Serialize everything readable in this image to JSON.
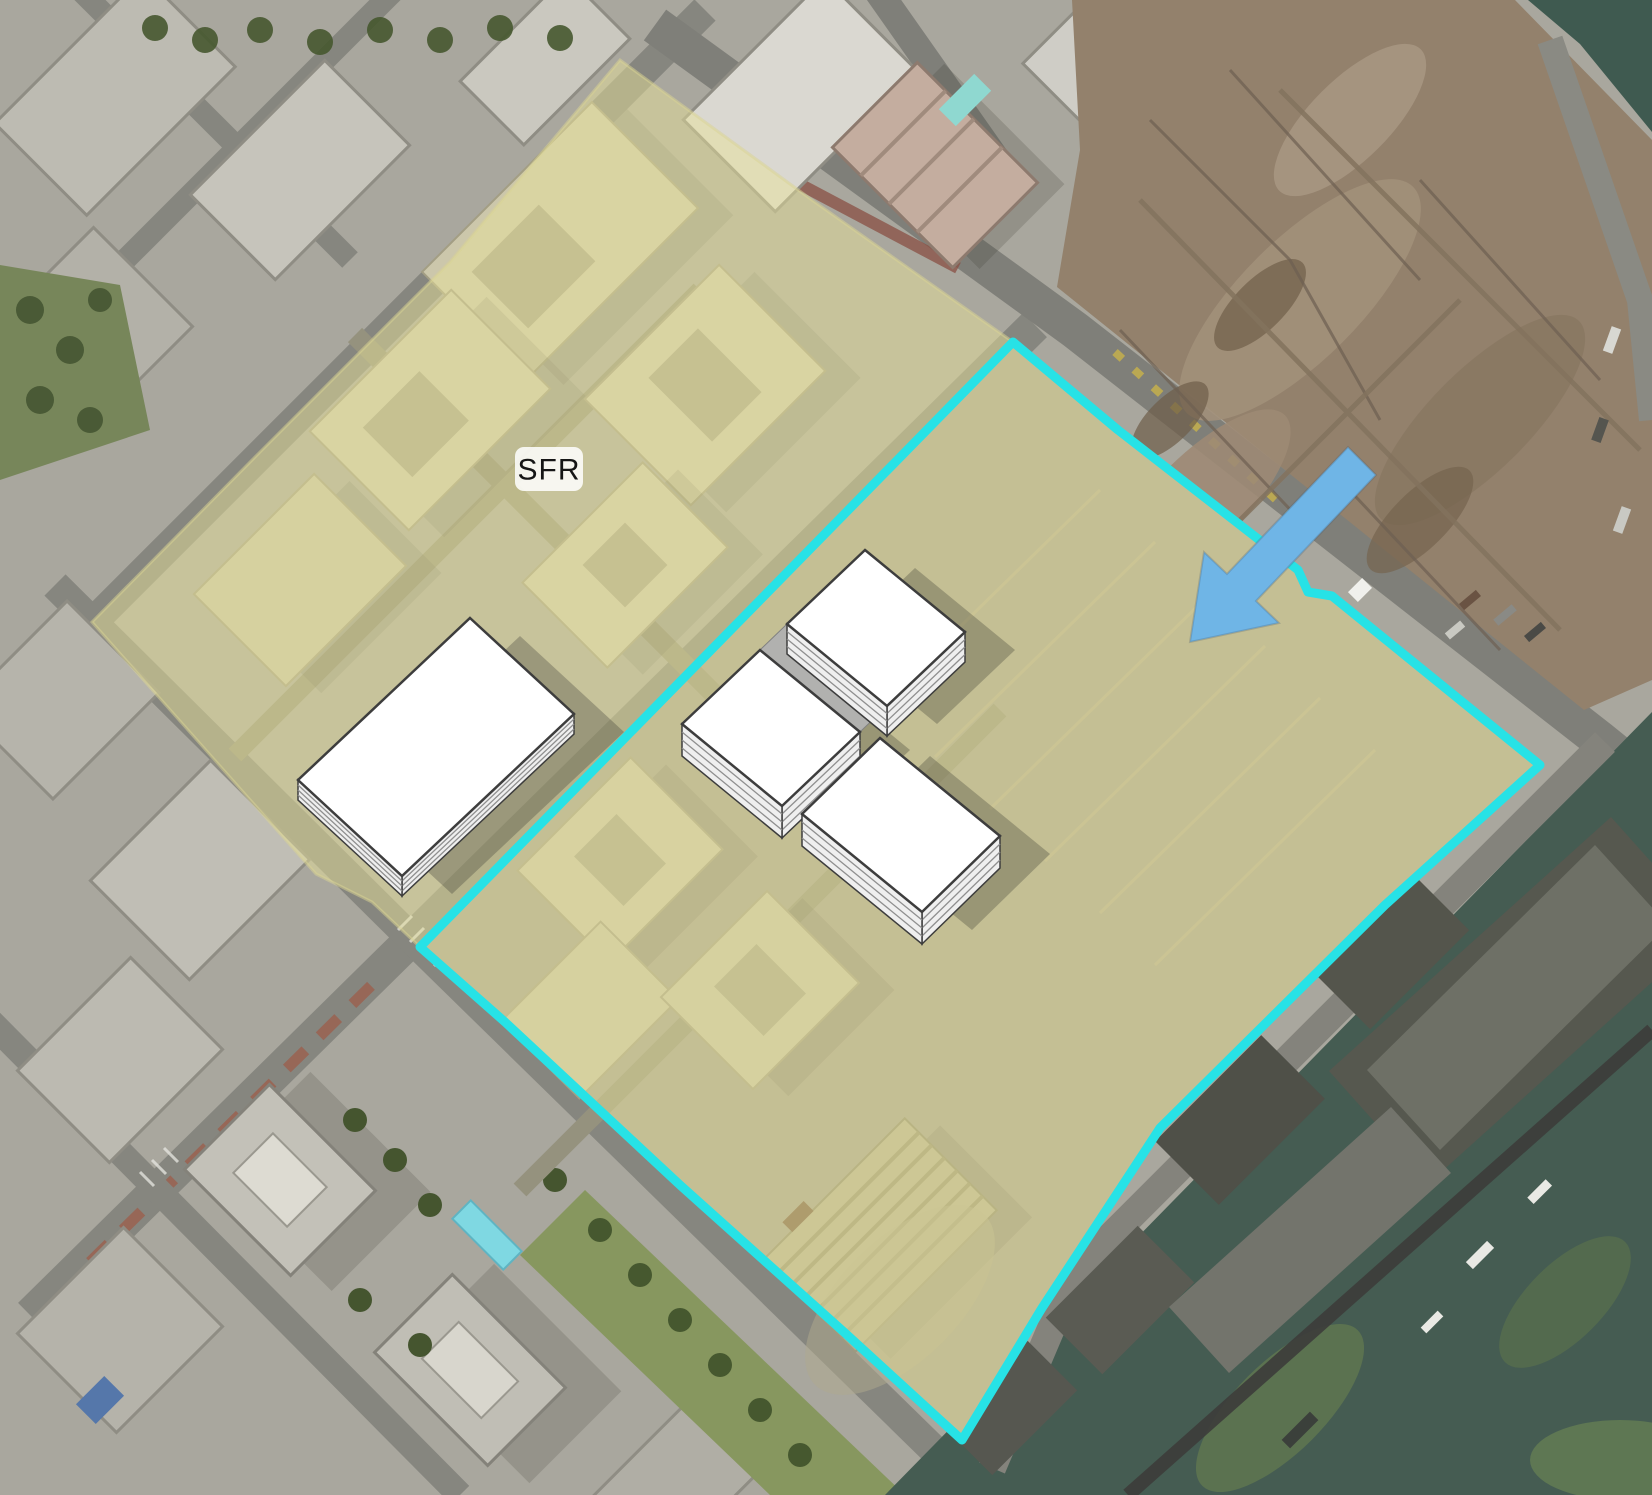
{
  "map": {
    "sfr_label_text": "SFR",
    "colors": {
      "site_fill": "#e7e198",
      "site_outline": "#27e2e6",
      "arrow_fill": "#6fb5e6",
      "massing_top": "#ffffff",
      "massing_outline": "#3d3d3d",
      "massing_side": "#efefef",
      "massing_floor_line": "#8f8f8f",
      "shadow": "#2b2b26",
      "dirt": "#93816c",
      "water": "#455c52",
      "urban": "#a9a79e",
      "label_bg": "#ffffff",
      "label_text": "#161616"
    },
    "annotations": {
      "highlight_opacity": 0.48,
      "highlight_polygon": [
        [
          620,
          60
        ],
        [
          812,
          200
        ],
        [
          1013,
          342
        ],
        [
          1118,
          430
        ],
        [
          1298,
          570
        ],
        [
          1308,
          592
        ],
        [
          1332,
          596
        ],
        [
          1540,
          765
        ],
        [
          1385,
          905
        ],
        [
          1160,
          1128
        ],
        [
          1042,
          1308
        ],
        [
          962,
          1440
        ],
        [
          845,
          1333
        ],
        [
          680,
          1185
        ],
        [
          505,
          1022
        ],
        [
          420,
          947
        ],
        [
          372,
          902
        ],
        [
          316,
          874
        ],
        [
          92,
          622
        ],
        [
          260,
          452
        ],
        [
          450,
          262
        ]
      ],
      "boundary_stroke_width": 9,
      "boundary_polygon": [
        [
          1013,
          342
        ],
        [
          1118,
          430
        ],
        [
          1298,
          570
        ],
        [
          1308,
          592
        ],
        [
          1332,
          596
        ],
        [
          1540,
          765
        ],
        [
          1385,
          905
        ],
        [
          1160,
          1128
        ],
        [
          1042,
          1308
        ],
        [
          962,
          1440
        ],
        [
          845,
          1333
        ],
        [
          680,
          1185
        ],
        [
          505,
          1022
        ],
        [
          420,
          947
        ]
      ],
      "massing_blocks": [
        {
          "top": [
            [
              470,
              618
            ],
            [
              574,
              714
            ],
            [
              402,
              876
            ],
            [
              298,
              780
            ]
          ],
          "h": 20
        },
        {
          "top": [
            [
              865,
              550
            ],
            [
              965,
              632
            ],
            [
              887,
              706
            ],
            [
              787,
              624
            ]
          ],
          "h": 30
        },
        {
          "top": [
            [
              760,
              650
            ],
            [
              860,
              732
            ],
            [
              782,
              806
            ],
            [
              682,
              724
            ]
          ],
          "h": 32
        },
        {
          "top": [
            [
              880,
              738
            ],
            [
              1000,
              836
            ],
            [
              922,
              912
            ],
            [
              802,
              814
            ]
          ],
          "h": 32
        }
      ],
      "podium_quad": [
        [
          787,
          624
        ],
        [
          887,
          706
        ],
        [
          860,
          732
        ],
        [
          760,
          650
        ]
      ],
      "shadow_offset": [
        50,
        18
      ],
      "arrow_polygon": [
        [
          1190,
          642
        ],
        [
          1204,
          552
        ],
        [
          1227,
          574
        ],
        [
          1348,
          447
        ],
        [
          1376,
          475
        ],
        [
          1256,
          601
        ],
        [
          1279,
          623
        ]
      ],
      "sfr_label": {
        "x": 549,
        "y": 469
      }
    }
  }
}
